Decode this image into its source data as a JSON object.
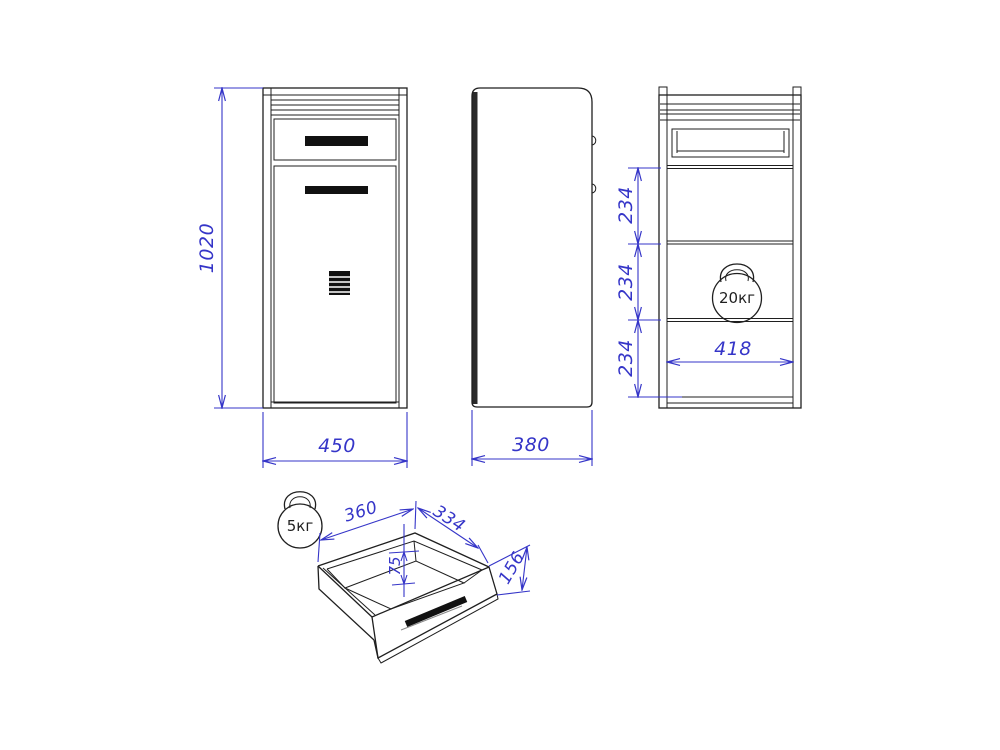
{
  "drawing": {
    "title_semantic": "cabinet-three-view-technical-drawing",
    "colors": {
      "line": "#1f1f1f",
      "dimension": "#3535c8"
    },
    "views": {
      "front": {
        "height_label": "1020",
        "width_label": "450"
      },
      "side": {
        "depth_label": "380"
      },
      "back": {
        "section_labels": [
          "234",
          "234",
          "234"
        ],
        "inner_width_label": "418",
        "weight_label": "20кг"
      },
      "drawer": {
        "width_label": "360",
        "depth_label": "334",
        "inner_depth_label": "75",
        "height_label": "156",
        "weight_label": "5кг"
      }
    }
  }
}
